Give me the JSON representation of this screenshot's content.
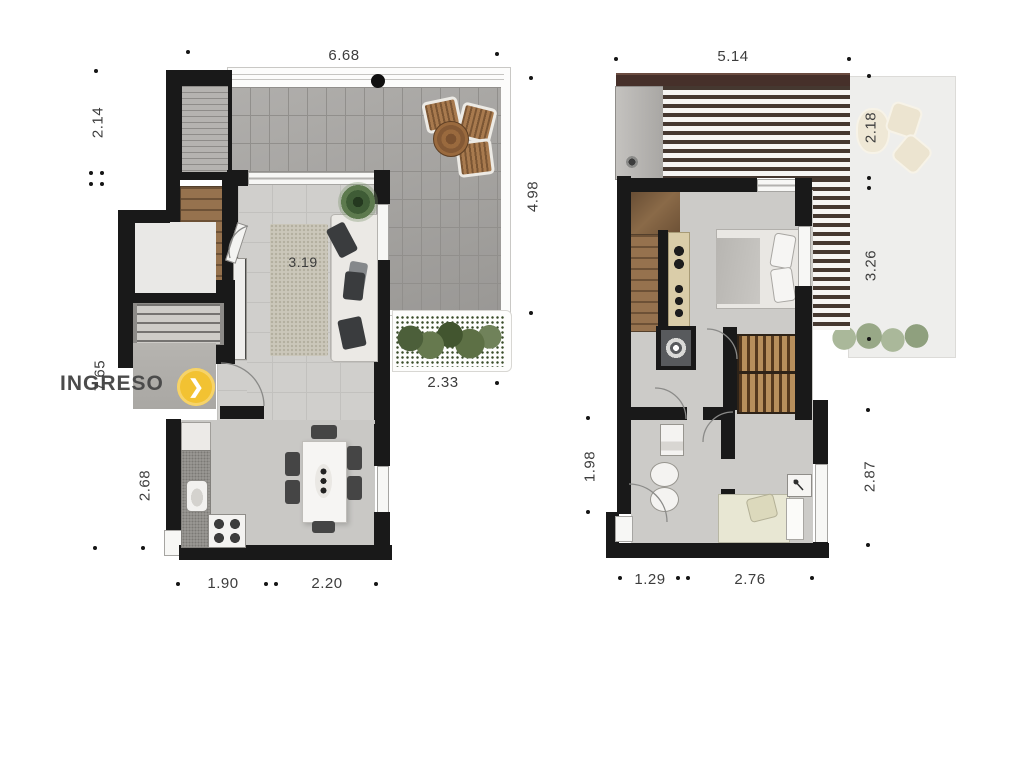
{
  "entrance": {
    "label": "INGRESO",
    "arrow_glyph": "❯",
    "badge_color": "#f2c232"
  },
  "dimensions": {
    "left_plan": {
      "top": "6.68",
      "side_left_upper": "2.14",
      "side_left_mid": "7.65",
      "side_left_lower": "2.68",
      "side_right": "4.98",
      "inner_terrace": "2.33",
      "inner_living": "3.19",
      "bottom_left": "1.90",
      "bottom_right": "2.20"
    },
    "right_plan": {
      "top": "5.14",
      "side_right_upper": "2.18",
      "side_right_mid": "3.26",
      "side_right_lower": "2.87",
      "side_left": "1.98",
      "bottom_left": "1.29",
      "bottom_right": "2.76"
    }
  },
  "colors": {
    "wall": "#191919",
    "accent_yellow": "#f2c232",
    "terrace_tile": "#a6a4a1",
    "wood": "#8a6a48",
    "greenery": "#5d7045"
  },
  "tick_dots": [
    [
      188,
      52
    ],
    [
      497,
      54
    ],
    [
      96,
      71
    ],
    [
      91,
      173
    ],
    [
      102,
      173
    ],
    [
      91,
      184
    ],
    [
      102,
      184
    ],
    [
      531,
      78
    ],
    [
      531,
      313
    ],
    [
      497,
      383
    ],
    [
      95,
      548
    ],
    [
      143,
      548
    ],
    [
      178,
      584
    ],
    [
      266,
      584
    ],
    [
      276,
      584
    ],
    [
      376,
      584
    ],
    [
      616,
      59
    ],
    [
      849,
      59
    ],
    [
      869,
      76
    ],
    [
      869,
      178
    ],
    [
      869,
      188
    ],
    [
      869,
      339
    ],
    [
      868,
      410
    ],
    [
      868,
      545
    ],
    [
      588,
      418
    ],
    [
      588,
      512
    ],
    [
      620,
      578
    ],
    [
      678,
      578
    ],
    [
      688,
      578
    ],
    [
      812,
      578
    ]
  ]
}
